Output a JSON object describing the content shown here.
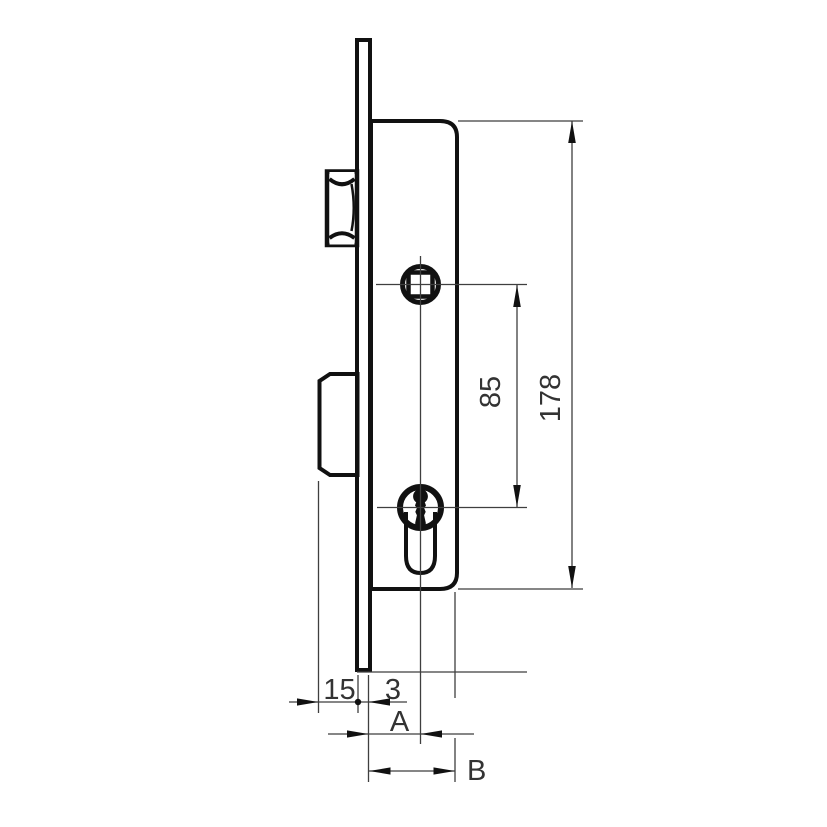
{
  "dims": {
    "case_height": "178",
    "spindle_to_cylinder": "85",
    "bolt_throw": "15",
    "faceplate_thickness": "3",
    "backset_label": "A",
    "case_depth_label": "B"
  },
  "colors": {
    "background": "#ffffff",
    "case_fill": "#d4d4d4",
    "bolt_fill": "#d8d8d8",
    "faceplate_fill": "#ededed",
    "hole_fill": "#ffffff",
    "outline": "#111111",
    "dimension_line": "#3f3f3f",
    "label_text": "#333333"
  },
  "part_names": [
    "lock-case",
    "faceplate",
    "latch-roller",
    "deadbolt",
    "spindle-follower",
    "euro-cylinder",
    "keyhole"
  ]
}
